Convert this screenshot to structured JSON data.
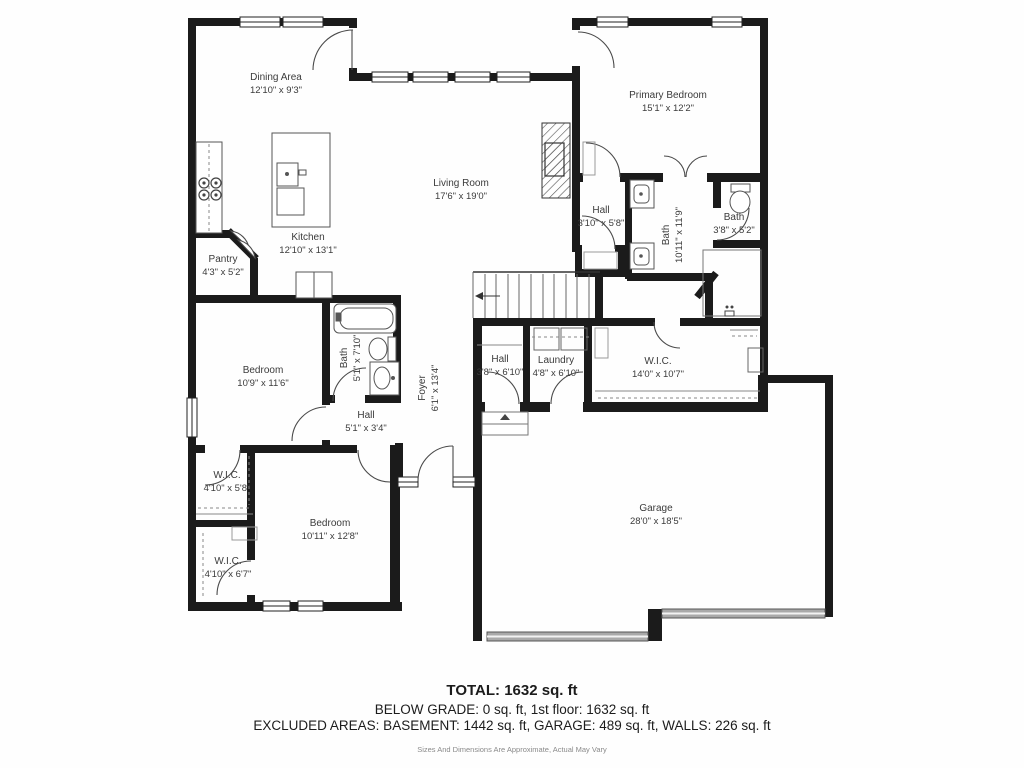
{
  "title": "First Floor Plan",
  "colors": {
    "walls": "#1b1b1b",
    "fixtures": "#4a4a4a",
    "garage_door": "#a9a9a9"
  },
  "rooms": {
    "dining": {
      "label": "Dining Area",
      "dims": "12'10\" x 9'3\""
    },
    "primary_bedroom": {
      "label": "Primary Bedroom",
      "dims": "15'1\" x 12'2\""
    },
    "living_room": {
      "label": "Living Room",
      "dims": "17'6\" x 19'0\""
    },
    "kitchen": {
      "label": "Kitchen",
      "dims": "12'10\" x 13'1\""
    },
    "pantry": {
      "label": "Pantry",
      "dims": "4'3\" x 5'2\""
    },
    "hall_a": {
      "label": "Hall",
      "dims": "3'10\" x 5'8\""
    },
    "bath_primary": {
      "label": "Bath",
      "dims": "10'11\" x 11'9\""
    },
    "bath_small": {
      "label": "Bath",
      "dims": "3'8\" x 5'2\""
    },
    "bedroom_a": {
      "label": "Bedroom",
      "dims": "10'9\" x 11'6\""
    },
    "bath_b": {
      "label": "Bath",
      "dims": "5'1\" x 7'10\""
    },
    "hall_b": {
      "label": "Hall",
      "dims": "5'1\" x 3'4\""
    },
    "foyer": {
      "label": "Foyer",
      "dims": "6'1\" x 13'4\""
    },
    "hall_c": {
      "label": "Hall",
      "dims": "3'8\" x 6'10\""
    },
    "laundry": {
      "label": "Laundry",
      "dims": "4'8\" x 6'10\""
    },
    "wic_main": {
      "label": "W.I.C.",
      "dims": "14'0\" x 10'7\""
    },
    "wic_1": {
      "label": "W.I.C.",
      "dims": "4'10\" x 5'8\""
    },
    "bedroom_b": {
      "label": "Bedroom",
      "dims": "10'11\" x 12'8\""
    },
    "wic_2": {
      "label": "W.I.C.",
      "dims": "4'10\" x 6'7\""
    },
    "garage": {
      "label": "Garage",
      "dims": "28'0\" x 18'5\""
    }
  },
  "summary": {
    "total": "TOTAL: 1632 sq. ft",
    "below_grade": "BELOW GRADE: 0 sq. ft, 1st floor: 1632 sq. ft",
    "excluded": "EXCLUDED AREAS: BASEMENT: 1442 sq. ft, GARAGE: 489 sq. ft, WALLS: 226 sq. ft",
    "disclaimer": "Sizes And Dimensions Are Approximate, Actual May Vary"
  }
}
